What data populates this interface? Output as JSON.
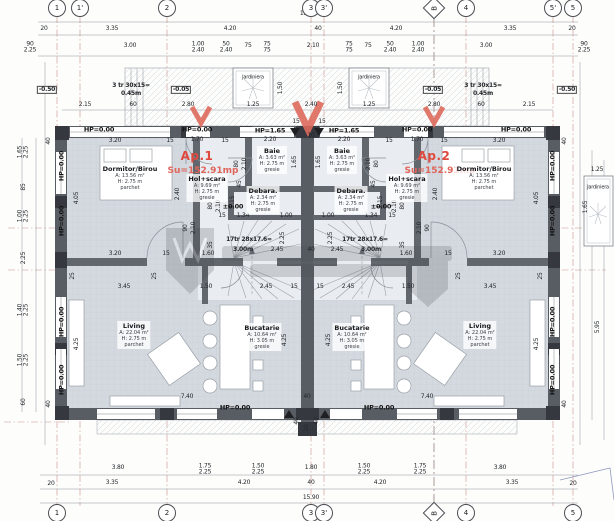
{
  "plan": {
    "ap1": {
      "name": "Ap.1",
      "area": "Su=152.91mp"
    },
    "ap2": {
      "name": "Ap.2",
      "area": "Su=152.91mp"
    },
    "watermark_visible": true
  },
  "rooms": [
    {
      "n": "Dormitor/Birou",
      "l": [
        "A: 13.56 m²",
        "H: 2.75 m",
        "parchet"
      ],
      "x": 130,
      "y": 178
    },
    {
      "n": "Dormitor/Birou",
      "l": [
        "A: 13.56 m²",
        "H: 2.75 m",
        "parchet"
      ],
      "x": 484,
      "y": 178
    },
    {
      "n": "Baie",
      "l": [
        "A: 3.63 m²",
        "H: 2.75 m",
        "gresie"
      ],
      "x": 272,
      "y": 160
    },
    {
      "n": "Baie",
      "l": [
        "A: 3.63 m²",
        "H: 2.75 m",
        "gresie"
      ],
      "x": 342,
      "y": 160
    },
    {
      "n": "Debara.",
      "l": [
        "A: 2.34 m²",
        "H: 2.75 m",
        "gresie"
      ],
      "x": 263,
      "y": 200
    },
    {
      "n": "Debara.",
      "l": [
        "A: 2.34 m²",
        "H: 2.75 m",
        "gresie"
      ],
      "x": 351,
      "y": 200
    },
    {
      "n": "Hol+scara",
      "l": [
        "A: 9.69 m²",
        "H: 2.75 m",
        "gresie"
      ],
      "x": 207,
      "y": 188
    },
    {
      "n": "Hol+scara",
      "l": [
        "A: 9.69 m²",
        "H: 2.75 m",
        "gresie"
      ],
      "x": 407,
      "y": 188
    },
    {
      "n": "Living",
      "l": [
        "A: 22.04 m²",
        "H: 2.75 m",
        "parchet"
      ],
      "x": 134,
      "y": 335
    },
    {
      "n": "Living",
      "l": [
        "A: 22.04 m²",
        "H: 2.75 m",
        "parchet"
      ],
      "x": 480,
      "y": 335
    },
    {
      "n": "Bucatarie",
      "l": [
        "A: 10.64 m²",
        "H: 3.05 m",
        "gresie"
      ],
      "x": 262,
      "y": 337
    },
    {
      "n": "Bucatarie",
      "l": [
        "A: 10.64 m²",
        "H: 3.05 m",
        "gresie"
      ],
      "x": 352,
      "y": 337
    }
  ],
  "axes": {
    "top": [
      {
        "l": "1",
        "x": 57
      },
      {
        "l": "1'",
        "x": 80
      },
      {
        "l": "2",
        "x": 167
      },
      {
        "l": "3",
        "x": 311
      },
      {
        "l": "3'",
        "x": 324
      },
      {
        "l": "B",
        "x": 434,
        "d": 1
      },
      {
        "l": "4",
        "x": 466
      },
      {
        "l": "5'",
        "x": 553
      },
      {
        "l": "5",
        "x": 573
      }
    ],
    "bottom": [
      {
        "l": "1",
        "x": 57
      },
      {
        "l": "2",
        "x": 167
      },
      {
        "l": "3",
        "x": 311
      },
      {
        "l": "3'",
        "x": 324
      },
      {
        "l": "B",
        "x": 434,
        "d": 1
      },
      {
        "l": "4",
        "x": 466
      },
      {
        "l": "5",
        "x": 573
      }
    ]
  },
  "dims": [
    {
      "t": "15.90",
      "x": 308,
      "y": 14
    },
    {
      "t": "20",
      "x": 44,
      "y": 29
    },
    {
      "t": "3.35",
      "x": 112,
      "y": 29
    },
    {
      "t": "4.20",
      "x": 230,
      "y": 29
    },
    {
      "t": "40",
      "x": 318,
      "y": 29
    },
    {
      "t": "4.20",
      "x": 396,
      "y": 29
    },
    {
      "t": "3.35",
      "x": 510,
      "y": 29
    },
    {
      "t": "20",
      "x": 572,
      "y": 29
    },
    {
      "t": "90\n2.25",
      "x": 30,
      "y": 48
    },
    {
      "t": "3.00",
      "x": 130,
      "y": 46
    },
    {
      "t": "1.00\n2.40",
      "x": 198,
      "y": 48
    },
    {
      "t": "50\n2.40",
      "x": 226,
      "y": 48
    },
    {
      "t": "75",
      "x": 248,
      "y": 46
    },
    {
      "t": "75\n75",
      "x": 267,
      "y": 48
    },
    {
      "t": "2.10",
      "x": 313,
      "y": 46
    },
    {
      "t": "75\n75",
      "x": 349,
      "y": 48
    },
    {
      "t": "75",
      "x": 368,
      "y": 46
    },
    {
      "t": "50\n2.40",
      "x": 390,
      "y": 48
    },
    {
      "t": "1.00\n2.40",
      "x": 418,
      "y": 48
    },
    {
      "t": "3.00",
      "x": 486,
      "y": 46
    },
    {
      "t": "90\n2.25",
      "x": 584,
      "y": 48
    },
    {
      "t": "-0.50",
      "x": 47,
      "y": 90,
      "cls": "box"
    },
    {
      "t": "3 tr 30x15=",
      "x": 131,
      "y": 86,
      "cls": "b"
    },
    {
      "t": "0.45m",
      "x": 131,
      "y": 94,
      "cls": "b"
    },
    {
      "t": "-0.05",
      "x": 181,
      "y": 90,
      "cls": "box"
    },
    {
      "t": "-0.05",
      "x": 433,
      "y": 90,
      "cls": "box"
    },
    {
      "t": "3 tr 30x15=",
      "x": 483,
      "y": 86,
      "cls": "b"
    },
    {
      "t": "0.45m",
      "x": 483,
      "y": 94,
      "cls": "b"
    },
    {
      "t": "-0.50",
      "x": 567,
      "y": 90,
      "cls": "box"
    },
    {
      "t": "Jardiniera",
      "x": 253,
      "y": 78,
      "cls": "sm"
    },
    {
      "t": "Jardiniera",
      "x": 369,
      "y": 78,
      "cls": "sm"
    },
    {
      "t": "Jardiniera",
      "x": 598,
      "y": 188,
      "cls": "sm"
    },
    {
      "t": "1.50",
      "x": 281,
      "y": 88,
      "r": 1
    },
    {
      "t": "1.50",
      "x": 341,
      "y": 88,
      "r": 1
    },
    {
      "t": "2.15",
      "x": 85,
      "y": 105
    },
    {
      "t": "60",
      "x": 133,
      "y": 105
    },
    {
      "t": "2.80",
      "x": 188,
      "y": 105
    },
    {
      "t": "1.25",
      "x": 253,
      "y": 105
    },
    {
      "t": "2.40",
      "x": 311,
      "y": 105
    },
    {
      "t": "1.25",
      "x": 369,
      "y": 105
    },
    {
      "t": "2.80",
      "x": 434,
      "y": 105
    },
    {
      "t": "60",
      "x": 481,
      "y": 105
    },
    {
      "t": "2.15",
      "x": 529,
      "y": 105
    },
    {
      "t": "1.25",
      "x": 597,
      "y": 170
    },
    {
      "t": "1.65",
      "x": 586,
      "y": 207,
      "r": 1
    },
    {
      "t": "5.95",
      "x": 598,
      "y": 327,
      "r": 1
    },
    {
      "t": "1.65\n2.25",
      "x": 24,
      "y": 152,
      "r": 1
    },
    {
      "t": "85",
      "x": 24,
      "y": 187,
      "r": 1
    },
    {
      "t": "1.00\n2.25",
      "x": 24,
      "y": 216,
      "r": 1
    },
    {
      "t": "2.25",
      "x": 24,
      "y": 258,
      "r": 1
    },
    {
      "t": "1.40\n2.25",
      "x": 24,
      "y": 310,
      "r": 1
    },
    {
      "t": "1.50\n2.25",
      "x": 24,
      "y": 360,
      "r": 1
    },
    {
      "t": "60",
      "x": 24,
      "y": 402,
      "r": 1
    },
    {
      "t": "HP=0.00",
      "x": 99,
      "y": 130,
      "cls": "hp"
    },
    {
      "t": "HP=0.00",
      "x": 197,
      "y": 130,
      "cls": "hp"
    },
    {
      "t": "1.70",
      "x": 197,
      "y": 140
    },
    {
      "t": "HP=1.65",
      "x": 270,
      "y": 131,
      "cls": "hp"
    },
    {
      "t": "2.20",
      "x": 270,
      "y": 140
    },
    {
      "t": "HP=1.65",
      "x": 344,
      "y": 131,
      "cls": "hp"
    },
    {
      "t": "2.20",
      "x": 344,
      "y": 140
    },
    {
      "t": "HP=0.00",
      "x": 417,
      "y": 130,
      "cls": "hp"
    },
    {
      "t": "1.70",
      "x": 417,
      "y": 140
    },
    {
      "t": "HP=0.00",
      "x": 516,
      "y": 130,
      "cls": "hp"
    },
    {
      "t": "HP=0.00",
      "x": 62,
      "y": 166,
      "cls": "hp",
      "r": 1
    },
    {
      "t": "HP=0.00",
      "x": 62,
      "y": 221,
      "cls": "hp",
      "r": 1
    },
    {
      "t": "HP=0.00",
      "x": 62,
      "y": 322,
      "cls": "hp",
      "r": 1
    },
    {
      "t": "HP=0.00",
      "x": 62,
      "y": 380,
      "cls": "hp",
      "r": 1
    },
    {
      "t": "HP=0.00",
      "x": 553,
      "y": 166,
      "cls": "hp",
      "r": 1
    },
    {
      "t": "HP=0.00",
      "x": 553,
      "y": 221,
      "cls": "hp",
      "r": 1
    },
    {
      "t": "HP=0.00",
      "x": 553,
      "y": 322,
      "cls": "hp",
      "r": 1
    },
    {
      "t": "HP=0.00",
      "x": 553,
      "y": 380,
      "cls": "hp",
      "r": 1
    },
    {
      "t": "3.20",
      "x": 115,
      "y": 141
    },
    {
      "t": "15",
      "x": 170,
      "y": 141
    },
    {
      "t": "15",
      "x": 225,
      "y": 141
    },
    {
      "t": "15",
      "x": 296,
      "y": 122
    },
    {
      "t": "10",
      "x": 311,
      "y": 136
    },
    {
      "t": "15",
      "x": 322,
      "y": 122
    },
    {
      "t": "15",
      "x": 389,
      "y": 141
    },
    {
      "t": "15",
      "x": 444,
      "y": 141
    },
    {
      "t": "3.20",
      "x": 499,
      "y": 141
    },
    {
      "t": "40",
      "x": 49,
      "y": 141,
      "r": 1
    },
    {
      "t": "40",
      "x": 565,
      "y": 141,
      "r": 1
    },
    {
      "t": "40",
      "x": 49,
      "y": 404,
      "r": 1
    },
    {
      "t": "40",
      "x": 565,
      "y": 404,
      "r": 1
    },
    {
      "t": "4.05",
      "x": 77,
      "y": 198,
      "r": 1
    },
    {
      "t": "2.40",
      "x": 178,
      "y": 194,
      "r": 1
    },
    {
      "t": "2.40",
      "x": 436,
      "y": 194,
      "r": 1
    },
    {
      "t": "4.05",
      "x": 537,
      "y": 198,
      "r": 1
    },
    {
      "t": "80",
      "x": 237,
      "y": 164,
      "r": 1
    },
    {
      "t": "2.10",
      "x": 245,
      "y": 164,
      "r": 1
    },
    {
      "t": "1.65",
      "x": 295,
      "y": 162,
      "r": 1
    },
    {
      "t": "1.65",
      "x": 319,
      "y": 162,
      "r": 1
    },
    {
      "t": "2.10",
      "x": 369,
      "y": 164,
      "r": 1
    },
    {
      "t": "80",
      "x": 377,
      "y": 164,
      "r": 1
    },
    {
      "t": "45",
      "x": 240,
      "y": 184,
      "r": 1
    },
    {
      "t": "45",
      "x": 374,
      "y": 184,
      "r": 1
    },
    {
      "t": "1.15",
      "x": 233,
      "y": 202,
      "r": 1
    },
    {
      "t": "1.15",
      "x": 381,
      "y": 202,
      "r": 1
    },
    {
      "t": "80",
      "x": 211,
      "y": 206,
      "r": 1
    },
    {
      "t": "2.10",
      "x": 219,
      "y": 206,
      "r": 1
    },
    {
      "t": "80",
      "x": 403,
      "y": 206,
      "r": 1
    },
    {
      "t": "2.10",
      "x": 395,
      "y": 206,
      "r": 1
    },
    {
      "t": "±0.00",
      "x": 233,
      "y": 207,
      "cls": "hp"
    },
    {
      "t": "±0.00",
      "x": 381,
      "y": 207,
      "cls": "hp"
    },
    {
      "t": "15",
      "x": 222,
      "y": 216
    },
    {
      "t": "1.34",
      "x": 243,
      "y": 216
    },
    {
      "t": "1.00",
      "x": 286,
      "y": 216
    },
    {
      "t": "1.00",
      "x": 328,
      "y": 216
    },
    {
      "t": "1.34",
      "x": 371,
      "y": 216
    },
    {
      "t": "15",
      "x": 392,
      "y": 216
    },
    {
      "t": "90",
      "x": 186,
      "y": 228,
      "r": 1
    },
    {
      "t": "2.10",
      "x": 194,
      "y": 228,
      "r": 1
    },
    {
      "t": "90",
      "x": 428,
      "y": 228,
      "r": 1
    },
    {
      "t": "2.10",
      "x": 420,
      "y": 228,
      "r": 1
    },
    {
      "t": "2.25",
      "x": 283,
      "y": 238,
      "r": 1
    },
    {
      "t": "2.25",
      "x": 331,
      "y": 238,
      "r": 1
    },
    {
      "t": "35",
      "x": 211,
      "y": 245,
      "r": 1
    },
    {
      "t": "35",
      "x": 403,
      "y": 245,
      "r": 1
    },
    {
      "t": "17tr 28x17.6=",
      "x": 249,
      "y": 240,
      "cls": "b"
    },
    {
      "t": "3.00m",
      "x": 243,
      "y": 250,
      "cls": "b"
    },
    {
      "t": "2.45",
      "x": 277,
      "y": 250
    },
    {
      "t": "40",
      "x": 311,
      "y": 250
    },
    {
      "t": "2.45",
      "x": 337,
      "y": 250
    },
    {
      "t": "3.00m",
      "x": 371,
      "y": 250,
      "cls": "b"
    },
    {
      "t": "17tr 28x17.6=",
      "x": 365,
      "y": 240,
      "cls": "b"
    },
    {
      "t": "3.20",
      "x": 115,
      "y": 254
    },
    {
      "t": "15",
      "x": 166,
      "y": 254
    },
    {
      "t": "1.60",
      "x": 208,
      "y": 254
    },
    {
      "t": "1.60",
      "x": 406,
      "y": 254
    },
    {
      "t": "15",
      "x": 448,
      "y": 254
    },
    {
      "t": "3.20",
      "x": 499,
      "y": 254
    },
    {
      "t": "25",
      "x": 73,
      "y": 276,
      "r": 1
    },
    {
      "t": "25",
      "x": 155,
      "y": 276,
      "r": 1
    },
    {
      "t": "25",
      "x": 459,
      "y": 276,
      "r": 1
    },
    {
      "t": "25",
      "x": 541,
      "y": 276,
      "r": 1
    },
    {
      "t": "3.45",
      "x": 124,
      "y": 287
    },
    {
      "t": "1.50",
      "x": 206,
      "y": 287
    },
    {
      "t": "2.45",
      "x": 266,
      "y": 287
    },
    {
      "t": "15",
      "x": 294,
      "y": 287
    },
    {
      "t": "15",
      "x": 320,
      "y": 287
    },
    {
      "t": "2.45",
      "x": 348,
      "y": 287
    },
    {
      "t": "1.50",
      "x": 408,
      "y": 287
    },
    {
      "t": "3.45",
      "x": 490,
      "y": 287
    },
    {
      "t": "4.25",
      "x": 77,
      "y": 344,
      "r": 1
    },
    {
      "t": "4.25",
      "x": 285,
      "y": 340,
      "r": 1
    },
    {
      "t": "4.25",
      "x": 329,
      "y": 340,
      "r": 1
    },
    {
      "t": "4.25",
      "x": 537,
      "y": 344,
      "r": 1
    },
    {
      "t": "7.40",
      "x": 187,
      "y": 397
    },
    {
      "t": "40",
      "x": 307,
      "y": 397
    },
    {
      "t": "7.40",
      "x": 427,
      "y": 397
    },
    {
      "t": "HP=0.00",
      "x": 235,
      "y": 408,
      "cls": "hp"
    },
    {
      "t": "HP=0.00",
      "x": 379,
      "y": 408,
      "cls": "hp"
    },
    {
      "t": "40",
      "x": 297,
      "y": 421,
      "r": 1
    },
    {
      "t": "40",
      "x": 317,
      "y": 421,
      "r": 1
    },
    {
      "t": "10",
      "x": 307,
      "y": 428,
      "r": 1
    },
    {
      "t": "3.80",
      "x": 118,
      "y": 468
    },
    {
      "t": "1.75\n2.25",
      "x": 205,
      "y": 470
    },
    {
      "t": "1.50\n2.25",
      "x": 258,
      "y": 470
    },
    {
      "t": "1.80",
      "x": 311,
      "y": 468
    },
    {
      "t": "1.50\n2.25",
      "x": 364,
      "y": 470
    },
    {
      "t": "1.75\n2.25",
      "x": 420,
      "y": 470
    },
    {
      "t": "3.80",
      "x": 500,
      "y": 468
    },
    {
      "t": "20",
      "x": 51,
      "y": 484
    },
    {
      "t": "3.35",
      "x": 112,
      "y": 483
    },
    {
      "t": "4.20",
      "x": 244,
      "y": 483
    },
    {
      "t": "40",
      "x": 311,
      "y": 483
    },
    {
      "t": "4.20",
      "x": 380,
      "y": 483
    },
    {
      "t": "3.35",
      "x": 512,
      "y": 483
    },
    {
      "t": "20",
      "x": 573,
      "y": 484
    },
    {
      "t": "15.90",
      "x": 311,
      "y": 498
    }
  ]
}
